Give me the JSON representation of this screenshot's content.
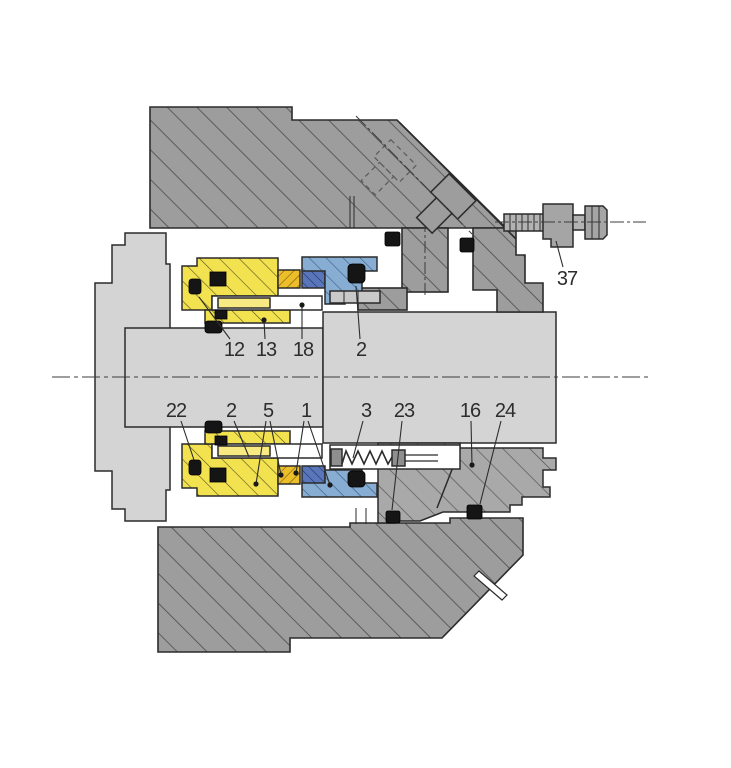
{
  "figure": {
    "kind": "technical-cross-section-diagram",
    "subject": "mechanical shaft seal assembly, hatched section view"
  },
  "colors": {
    "background": "#ffffff",
    "housing_gray": "#9d9d9d",
    "gland_gray": "#a9a9a9",
    "shaft_gray": "#d4d4d4",
    "rotary_unit_yellow": "#f3e24f",
    "seal_face_gold": "#ecbe2a",
    "seat_holder_blue": "#87add2",
    "stationary_seat_dark_blue": "#5a76bb",
    "elastomer_black": "#151515",
    "line_dark": "#2b2b2b",
    "pin_yellow": "#f7ea82",
    "metal_light": "#b3b3b3"
  },
  "parts": [
    {
      "name": "upper-housing",
      "fill": "housing_gray",
      "hatched": true
    },
    {
      "name": "lower-housing",
      "fill": "housing_gray",
      "hatched": true
    },
    {
      "name": "gland-plate",
      "fill": "gland_gray",
      "hatched": true
    },
    {
      "name": "shaft",
      "fill": "shaft_gray",
      "hatched": false
    },
    {
      "name": "rotary-seal-unit",
      "fill": "rotary_unit_yellow",
      "hatched": true
    },
    {
      "name": "seal-face",
      "fill": "seal_face_gold",
      "hatched": true
    },
    {
      "name": "stationary-seat",
      "fill": "stationary_seat_dark_blue",
      "hatched": true
    },
    {
      "name": "seat-holder",
      "fill": "seat_holder_blue",
      "hatched": true
    },
    {
      "name": "spring",
      "fill": "metal_light",
      "hatched": false
    },
    {
      "name": "o-rings",
      "fill": "elastomer_black",
      "hatched": false
    }
  ],
  "labels": [
    {
      "text": "12",
      "x": 234,
      "y": 349,
      "points_to": "black-o-ring-upper-left",
      "leaders": [
        {
          "x1": 230,
          "y1": 339,
          "x2": 199,
          "y2": 297,
          "dot": false
        }
      ]
    },
    {
      "text": "13",
      "x": 266,
      "y": 349,
      "points_to": "yellow-rotary-unit-band",
      "leaders": [
        {
          "x1": 265,
          "y1": 339,
          "x2": 264,
          "y2": 320,
          "dot": true
        }
      ]
    },
    {
      "text": "18",
      "x": 303,
      "y": 349,
      "points_to": "drive-pin-slot",
      "leaders": [
        {
          "x1": 302,
          "y1": 339,
          "x2": 302,
          "y2": 305,
          "dot": true
        }
      ]
    },
    {
      "text": "2",
      "x": 361,
      "y": 349,
      "points_to": "black-o-ring-at-seat-upper",
      "leaders": [
        {
          "x1": 360,
          "y1": 339,
          "x2": 356,
          "y2": 286,
          "dot": false
        }
      ]
    },
    {
      "text": "37",
      "x": 567,
      "y": 278,
      "points_to": "clamp-screw-block",
      "leaders": [
        {
          "x1": 563,
          "y1": 267,
          "x2": 556,
          "y2": 241,
          "dot": false
        }
      ]
    },
    {
      "text": "22",
      "x": 176,
      "y": 410,
      "points_to": "black-o-ring-lower-left",
      "leaders": [
        {
          "x1": 181,
          "y1": 421,
          "x2": 194,
          "y2": 460,
          "dot": false
        }
      ]
    },
    {
      "text": "2",
      "x": 231,
      "y": 410,
      "points_to": "yellow-rotary-unit-lower",
      "leaders": [
        {
          "x1": 234,
          "y1": 421,
          "x2": 249,
          "y2": 457,
          "dot": false
        }
      ]
    },
    {
      "text": "5",
      "x": 268,
      "y": 410,
      "points_to": "gold-seal-face-lower",
      "leaders": [
        {
          "x1": 266,
          "y1": 421,
          "x2": 256,
          "y2": 484,
          "dot": true
        },
        {
          "x1": 270,
          "y1": 421,
          "x2": 281,
          "y2": 475,
          "dot": true
        }
      ]
    },
    {
      "text": "1",
      "x": 306,
      "y": 410,
      "points_to": "stationary-seat-lower",
      "leaders": [
        {
          "x1": 304,
          "y1": 421,
          "x2": 296,
          "y2": 473,
          "dot": true
        },
        {
          "x1": 308,
          "y1": 421,
          "x2": 330,
          "y2": 485,
          "dot": true
        }
      ]
    },
    {
      "text": "3",
      "x": 366,
      "y": 410,
      "points_to": "spring",
      "leaders": [
        {
          "x1": 363,
          "y1": 421,
          "x2": 353,
          "y2": 458,
          "dot": false
        }
      ]
    },
    {
      "text": "23",
      "x": 404,
      "y": 410,
      "points_to": "black-o-ring-gland-lower",
      "leaders": [
        {
          "x1": 402,
          "y1": 421,
          "x2": 392,
          "y2": 510,
          "dot": false
        }
      ]
    },
    {
      "text": "16",
      "x": 470,
      "y": 410,
      "points_to": "clamp-sleeve",
      "leaders": [
        {
          "x1": 471,
          "y1": 421,
          "x2": 472,
          "y2": 465,
          "dot": true
        }
      ]
    },
    {
      "text": "24",
      "x": 505,
      "y": 410,
      "points_to": "black-o-ring-sleeve",
      "leaders": [
        {
          "x1": 501,
          "y1": 421,
          "x2": 480,
          "y2": 504,
          "dot": false
        }
      ]
    }
  ]
}
